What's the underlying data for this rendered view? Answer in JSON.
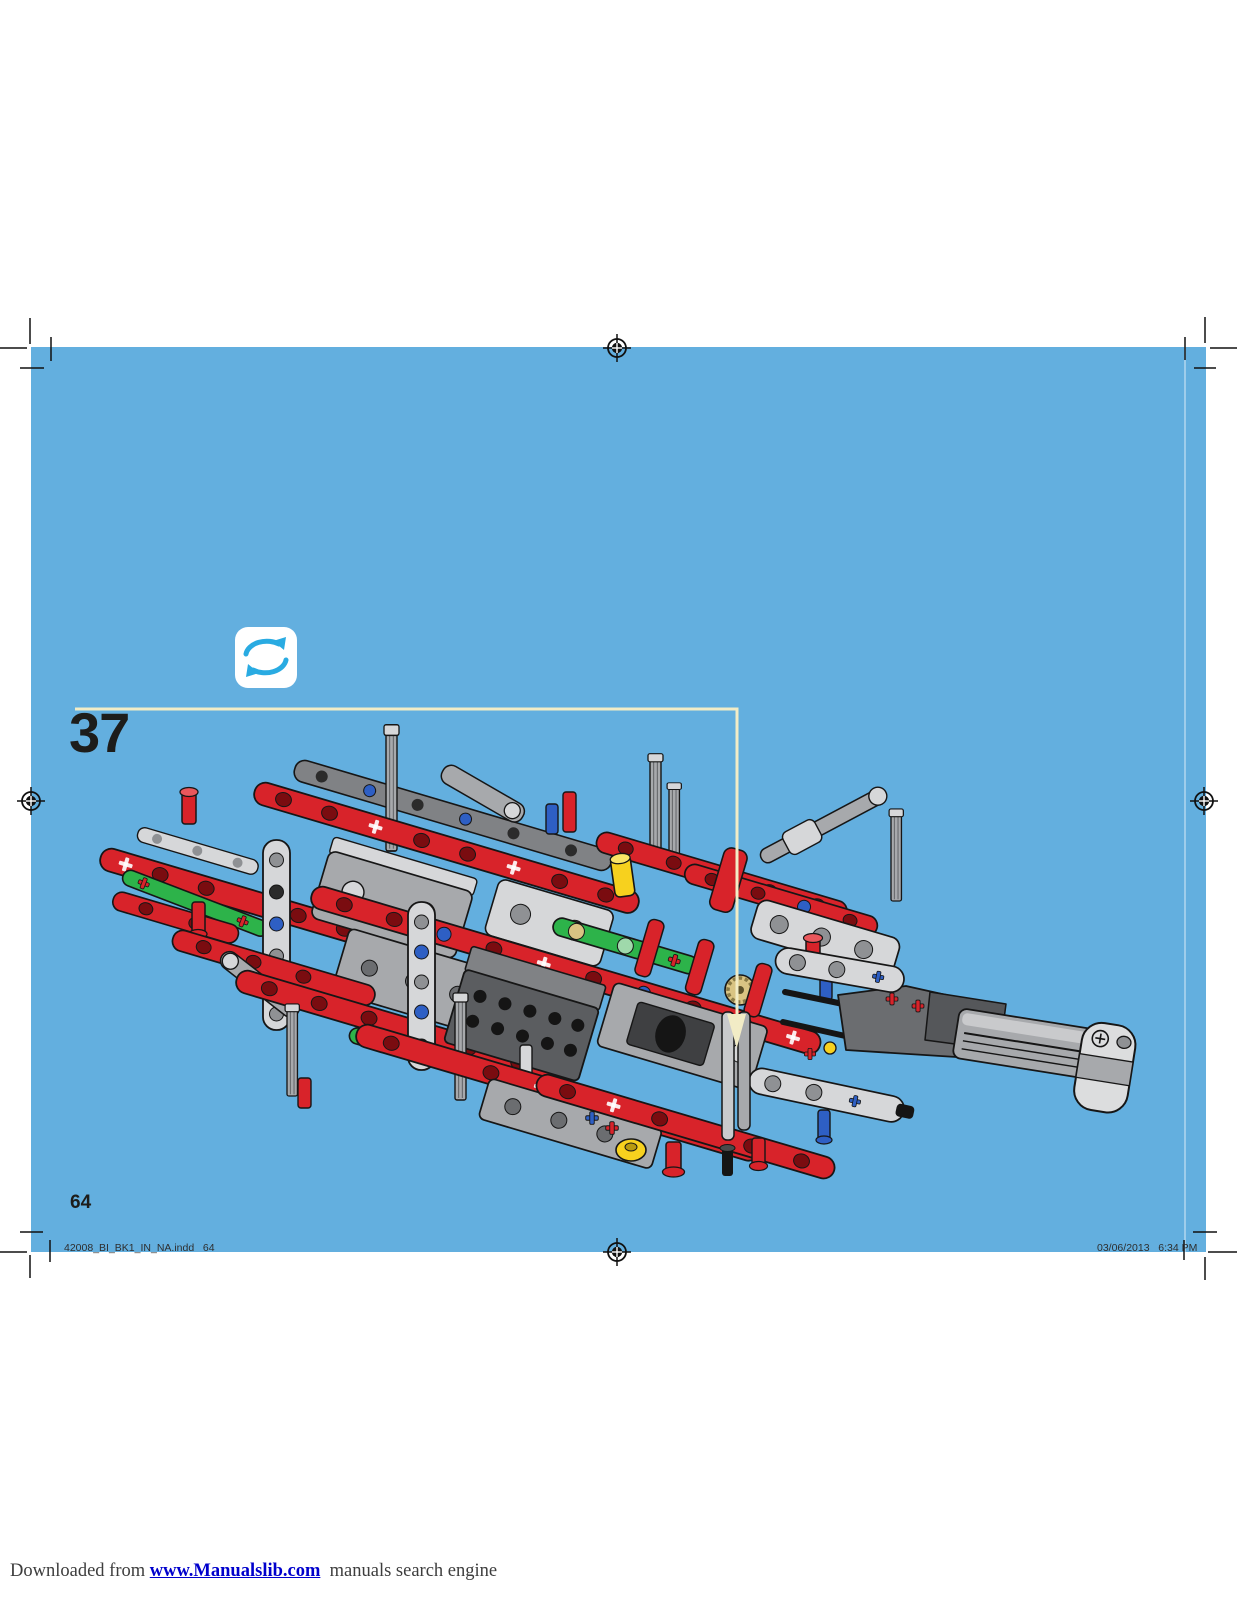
{
  "page": {
    "background_color": "#63AFDF",
    "step_number": "37",
    "page_number": "64"
  },
  "step_callout": {
    "line_color": "#F2ECC6",
    "shape": "line-with-down-arrow"
  },
  "rotate_icon": {
    "meaning": "rotate-model-instruction",
    "arrow_color": "#29ABE2",
    "background": "#FFFFFF"
  },
  "model": {
    "description": "LEGO Technic chassis assembly with linear actuator arm, step 37",
    "palette": {
      "red": "#D8232A",
      "hole_dark": "#7A0C10",
      "gray_light": "#D6D7D9",
      "gray_mid": "#A7A9AC",
      "gray_dark": "#6B6D70",
      "gray_darker": "#3F4042",
      "green": "#2DB34A",
      "yellow": "#F7D11E",
      "blue_pin": "#2E5FC4",
      "tan_gear": "#D9C483",
      "outline": "#161616"
    }
  },
  "print_marks": {
    "registration_mark_count": 4,
    "corner_crop_marks": true
  },
  "footer": {
    "left": "42008_BI_BK1_IN_NA.indd   64",
    "right": "03/06/2013   6:34 PM"
  },
  "bottom_bar": {
    "prefix": "Downloaded from ",
    "link_text": "www.Manualslib.com",
    "suffix": "  manuals search engine",
    "link_color": "#0000CC"
  }
}
